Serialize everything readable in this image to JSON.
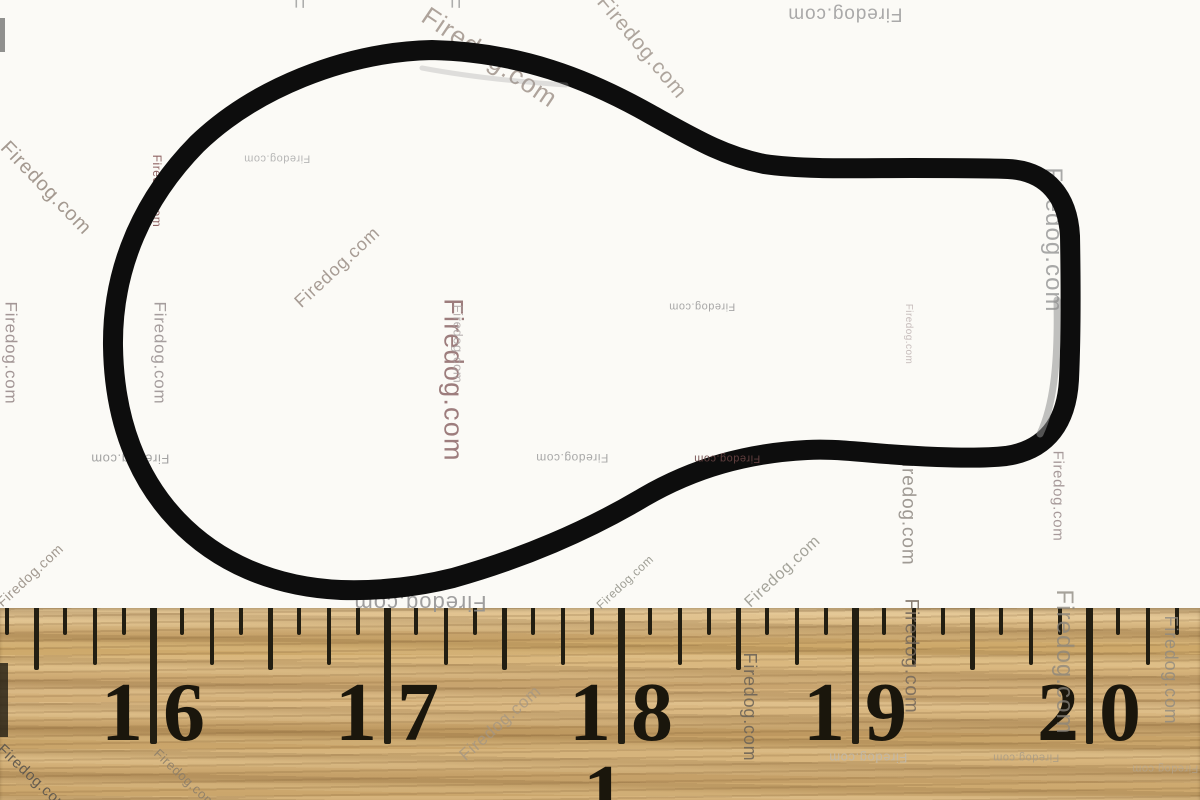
{
  "meta": {
    "description": "Product photograph of a black rubber keyhole-shaped gasket seal lying above a wooden ruler",
    "background_color": "#fbfaf6"
  },
  "watermark": {
    "text": "Firedog.com",
    "instances": [
      {
        "x": 490,
        "y": 57,
        "rot": 34,
        "size": 26,
        "color": "#9b8e85",
        "opacity": 0.8
      },
      {
        "x": 296,
        "y": 3,
        "rot": 90,
        "size": 20,
        "color": "#9a9a9a",
        "opacity": 0.8,
        "text": "F"
      },
      {
        "x": 452,
        "y": 3,
        "rot": 90,
        "size": 20,
        "color": "#9a9a9a",
        "opacity": 0.8,
        "text": "F"
      },
      {
        "x": 642,
        "y": 47,
        "rot": 50,
        "size": 21,
        "color": "#9b9188",
        "opacity": 0.8
      },
      {
        "x": 845,
        "y": 14,
        "rot": 180,
        "size": 19,
        "color": "#9c9c9c",
        "opacity": 0.85
      },
      {
        "x": 46,
        "y": 188,
        "rot": 46,
        "size": 20,
        "color": "#95897f",
        "opacity": 0.85
      },
      {
        "x": 11,
        "y": 353,
        "rot": 90,
        "size": 17,
        "color": "#9a8c8c",
        "opacity": 0.9
      },
      {
        "x": 157,
        "y": 191,
        "rot": 90,
        "size": 12,
        "color": "#8a5c5c",
        "opacity": 0.95
      },
      {
        "x": 160,
        "y": 353,
        "rot": 90,
        "size": 17,
        "color": "#9c9494",
        "opacity": 0.9
      },
      {
        "x": 277,
        "y": 158,
        "rot": 180,
        "size": 11,
        "color": "#ababab",
        "opacity": 0.85
      },
      {
        "x": 337,
        "y": 267,
        "rot": -43,
        "size": 18,
        "color": "#998c84",
        "opacity": 0.85
      },
      {
        "x": 453,
        "y": 380,
        "rot": 90,
        "size": 27,
        "color": "#8d6868",
        "opacity": 0.85
      },
      {
        "x": 458,
        "y": 344,
        "rot": 90,
        "size": 13,
        "color": "#a9a1a1",
        "opacity": 0.8
      },
      {
        "x": 702,
        "y": 306,
        "rot": 180,
        "size": 11,
        "color": "#9e9e9e",
        "opacity": 0.9
      },
      {
        "x": 572,
        "y": 458,
        "rot": 180,
        "size": 12,
        "color": "#a0a0a0",
        "opacity": 0.9
      },
      {
        "x": 908,
        "y": 334,
        "rot": 90,
        "size": 10,
        "color": "#b5a8a8",
        "opacity": 0.75
      },
      {
        "x": 1053,
        "y": 240,
        "rot": 90,
        "size": 24,
        "color": "#9a9a9a",
        "opacity": 0.85
      },
      {
        "x": 908,
        "y": 508,
        "rot": 90,
        "size": 19,
        "color": "#96908a",
        "opacity": 0.9
      },
      {
        "x": 1058,
        "y": 496,
        "rot": 90,
        "size": 15,
        "color": "#9d8f8f",
        "opacity": 0.9
      },
      {
        "x": 420,
        "y": 603,
        "rot": 180,
        "size": 22,
        "color": "#8f8f8f",
        "opacity": 0.85
      },
      {
        "x": 130,
        "y": 459,
        "rot": 180,
        "size": 13,
        "color": "#9a9a9a",
        "opacity": 0.9
      },
      {
        "x": 750,
        "y": 707,
        "rot": 90,
        "size": 18,
        "color": "#6e6558",
        "opacity": 0.9
      },
      {
        "x": 911,
        "y": 656,
        "rot": 90,
        "size": 19,
        "color": "#75695c",
        "opacity": 0.85
      },
      {
        "x": 1064,
        "y": 662,
        "rot": 90,
        "size": 24,
        "color": "#8a857c",
        "opacity": 0.75
      },
      {
        "x": 1171,
        "y": 670,
        "rot": 90,
        "size": 18,
        "color": "#8f8a80",
        "opacity": 0.8
      },
      {
        "x": 868,
        "y": 758,
        "rot": 180,
        "size": 13,
        "color": "#c0b9ac",
        "opacity": 0.9
      },
      {
        "x": 1026,
        "y": 757,
        "rot": 180,
        "size": 11,
        "color": "#a59a88",
        "opacity": 0.8
      },
      {
        "x": 1165,
        "y": 768,
        "rot": 180,
        "size": 11,
        "color": "#b0a89c",
        "opacity": 0.6
      },
      {
        "x": 30,
        "y": 575,
        "rot": -43,
        "size": 14,
        "color": "#93897f",
        "opacity": 0.85
      },
      {
        "x": 33,
        "y": 778,
        "rot": 43,
        "size": 15,
        "color": "#5f584e",
        "opacity": 0.95
      },
      {
        "x": 185,
        "y": 778,
        "rot": 43,
        "size": 13,
        "color": "#8a7d6a",
        "opacity": 0.85
      },
      {
        "x": 500,
        "y": 723,
        "rot": -42,
        "size": 17,
        "color": "#a39684",
        "opacity": 0.75
      },
      {
        "x": 625,
        "y": 582,
        "rot": -43,
        "size": 12,
        "color": "#8f8f85",
        "opacity": 0.85
      },
      {
        "x": 783,
        "y": 572,
        "rot": -43,
        "size": 16,
        "color": "#95948a",
        "opacity": 0.85
      },
      {
        "x": 727,
        "y": 458,
        "rot": 180,
        "size": 11,
        "color": "#6a4444",
        "opacity": 0.9,
        "over": true
      }
    ]
  },
  "gasket": {
    "name": "black rubber gasket seal (keyhole shaped)",
    "stroke_color": "#0d0d0d",
    "stroke_width": 20,
    "outline_path": "M 432 50 C 520 52 588 79 650 114 C 697 140 724 156 764 164 C 804 170 862 168 912 168 C 952 168 986 168 1008 169 C 1048 171 1068 198 1070 236 C 1071 291 1071 336 1069 379 C 1067 421 1048 450 1006 456 C 970 460 906 456 863 452 C 839 450 823 449 807 450 C 747 453 694 468 644 497 C 587 531 521 559 453 578 C 413 588 373 591 341 590 C 273 587 217 562 177 520 C 138 479 114 421 113 346 C 112 267 144 198 197 144 C 253 90 343 52 432 50 Z",
    "highlights": [
      {
        "path": "M 1057 300 C 1058 350 1056 400 1040 434",
        "color": "#909090",
        "width": 7,
        "opacity": 0.55
      },
      {
        "path": "M 422 68 C 470 77 520 82 566 85",
        "color": "#9a9a9a",
        "width": 5,
        "opacity": 0.3
      }
    ]
  },
  "ruler": {
    "unit": "inches",
    "numbers": [
      "16",
      "17",
      "18",
      "19",
      "20"
    ],
    "inch_tick_x": [
      153,
      387,
      621,
      855,
      1089
    ],
    "eighth_spacing": 29.25,
    "wood_top_y": 608,
    "tick_color": "#221e12",
    "number_color": "#1a160c",
    "number_font_px": 84,
    "number_top_y": 680,
    "digit_gap_px": 20,
    "tick_styles": {
      "inch": {
        "len": 136,
        "w": 7
      },
      "half": {
        "len": 62,
        "w": 5
      },
      "quarter": {
        "len": 57,
        "w": 4
      },
      "eighth": {
        "len": 27,
        "w": 4
      }
    },
    "partial_digit": {
      "text": "1",
      "x": 604,
      "y": 762
    },
    "edge_mark": {
      "x": 0,
      "y": 663,
      "w": 8,
      "h": 74,
      "color": "#2a2418",
      "opacity": 0.85
    }
  },
  "artifacts": [
    {
      "x": 0,
      "y": 18,
      "w": 5,
      "h": 34,
      "color": "#4a4a4a",
      "opacity": 0.6
    }
  ]
}
